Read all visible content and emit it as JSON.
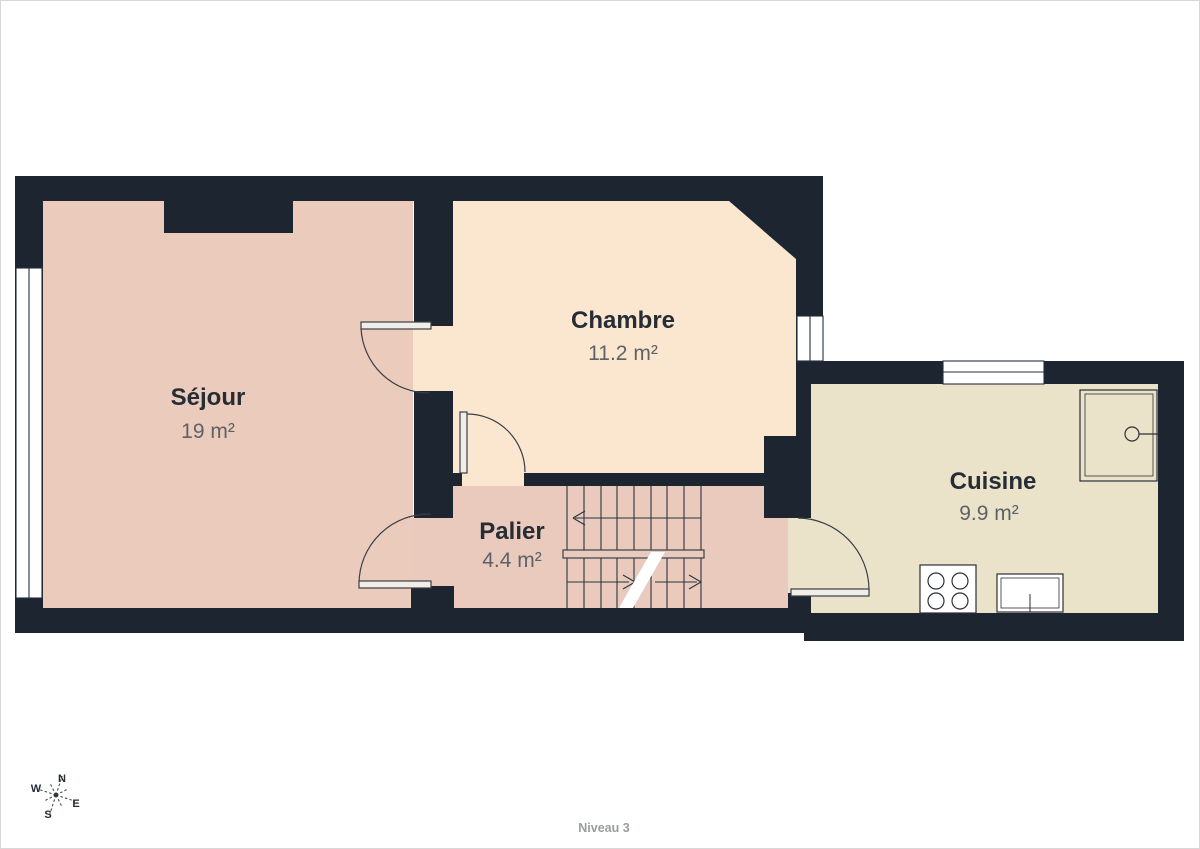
{
  "palette": {
    "wall": "#1d2531",
    "sejour_fill": "#ebcbbb",
    "palier_fill": "#e9cabc",
    "chambre_fill": "#fbe7d0",
    "cuisine_fill": "#eae3ca",
    "window_fill": "#ffffff",
    "door_leaf_fill": "#f1ede8",
    "label_color": "#262d36",
    "area_color": "#5d6269"
  },
  "rooms": [
    {
      "id": "sejour",
      "name": "Séjour",
      "area": "19 m²"
    },
    {
      "id": "chambre",
      "name": "Chambre",
      "area": "11.2 m²"
    },
    {
      "id": "palier",
      "name": "Palier",
      "area": "4.4 m²"
    },
    {
      "id": "cuisine",
      "name": "Cuisine",
      "area": "9.9 m²"
    }
  ],
  "compass": {
    "north": "N",
    "east": "E",
    "south": "S",
    "west": "W"
  },
  "footer": {
    "level_label": "Niveau 3"
  }
}
